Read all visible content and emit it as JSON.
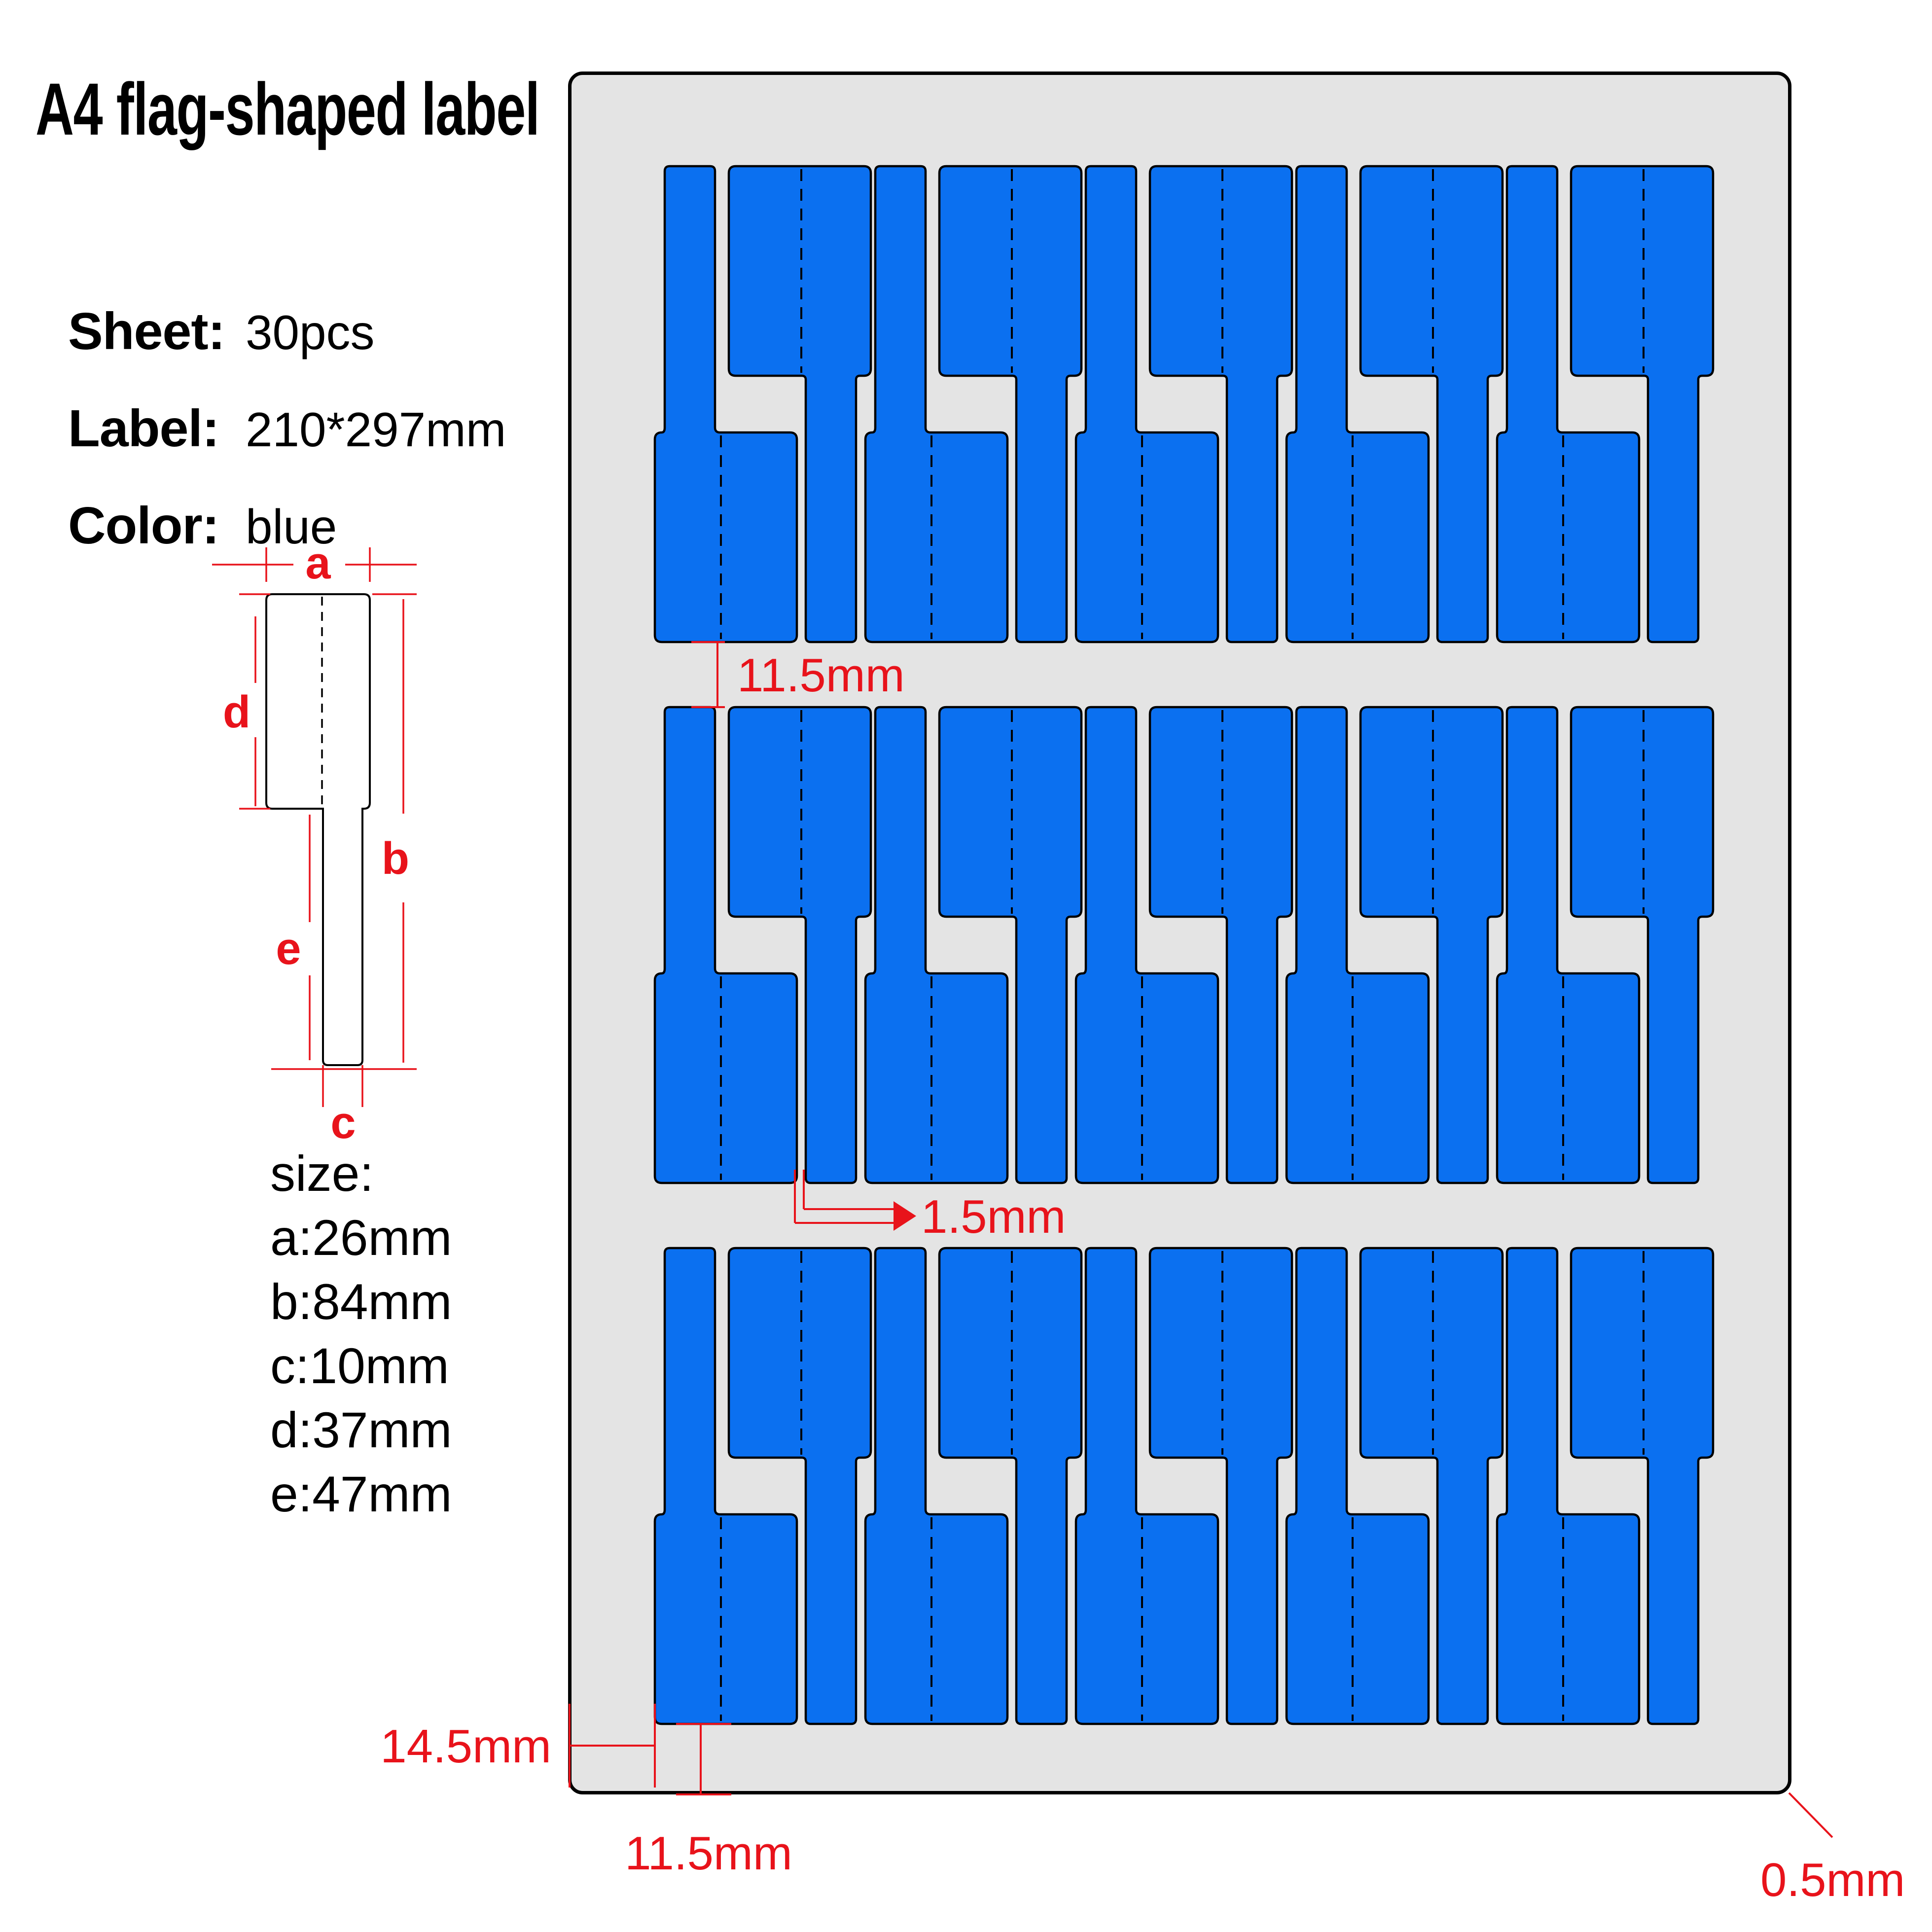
{
  "title": "A4 flag-shaped label",
  "specs": [
    {
      "label": "Sheet:",
      "value": "30pcs"
    },
    {
      "label": "Label:",
      "value": "210*297mm"
    },
    {
      "label": "Color:",
      "value": "blue"
    }
  ],
  "size_list": {
    "heading": "size:",
    "items": [
      {
        "key": "a:",
        "value": "26mm"
      },
      {
        "key": "b:",
        "value": "84mm"
      },
      {
        "key": "c:",
        "value": "10mm"
      },
      {
        "key": "d:",
        "value": "37mm"
      },
      {
        "key": "e:",
        "value": "47mm"
      }
    ]
  },
  "diagram": {
    "dim_a": "a",
    "dim_b": "b",
    "dim_c": "c",
    "dim_d": "d",
    "dim_e": "e"
  },
  "annotations": {
    "row_gap": "11.5mm",
    "cut_gap": "1.5mm",
    "left_margin": "14.5mm",
    "bottom_margin": "11.5mm",
    "sheet_corner": "0.5mm"
  },
  "colors": {
    "label_blue": "#0B70F0",
    "sheet_gray": "#E4E4E4",
    "annotation_red": "#E8131B"
  }
}
